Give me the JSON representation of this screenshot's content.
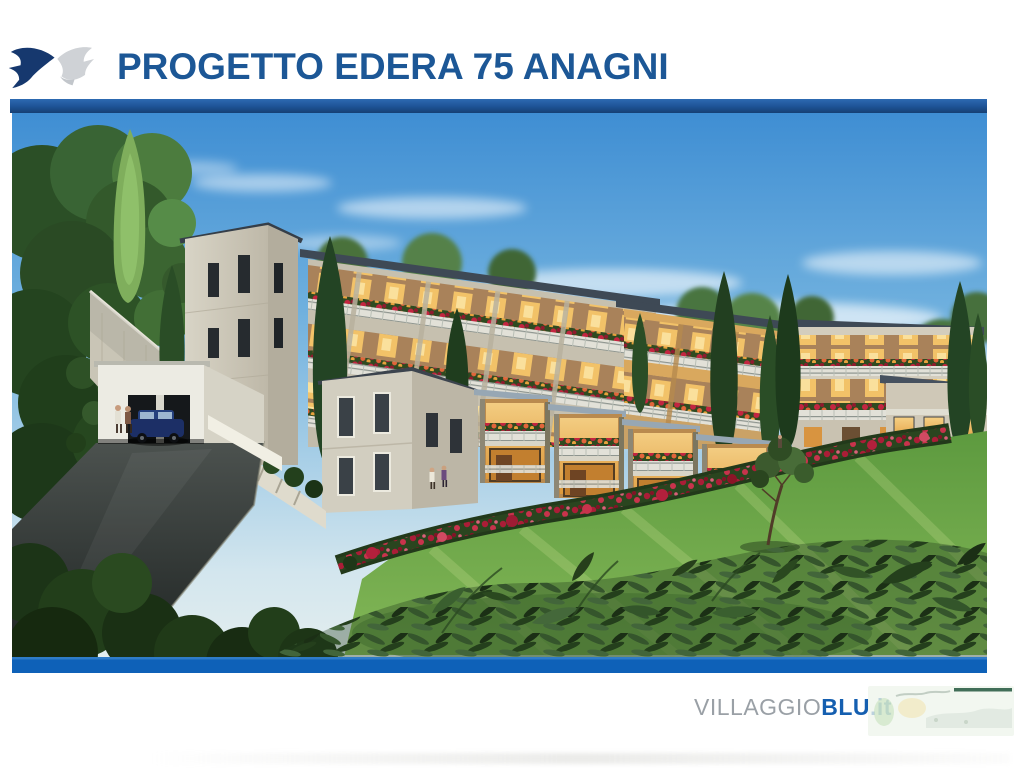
{
  "header": {
    "title": "PROGETTO EDERA 75 ANAGNI"
  },
  "footer": {
    "brand_gray": "VILLAGGIO",
    "brand_blue": "BLU",
    "brand_suffix": ".it"
  },
  "illustration": {
    "description": "Architectural rendering of a terraced residential complex on a green hillside: stone apartment blocks with flower-filled balconies, warm lit windows, cypress trees, a rose hedge, a lawn, a driveway with a parked car and pedestrians"
  },
  "colors": {
    "title_blue": "#1c5796",
    "rule_blue": "#1d5295",
    "photo_bottom_bar_blue": "#0e61b8",
    "brand_gray": "#9aa0a6",
    "brand_blue": "#155fb0",
    "watermark_green": "#2d5f47"
  }
}
